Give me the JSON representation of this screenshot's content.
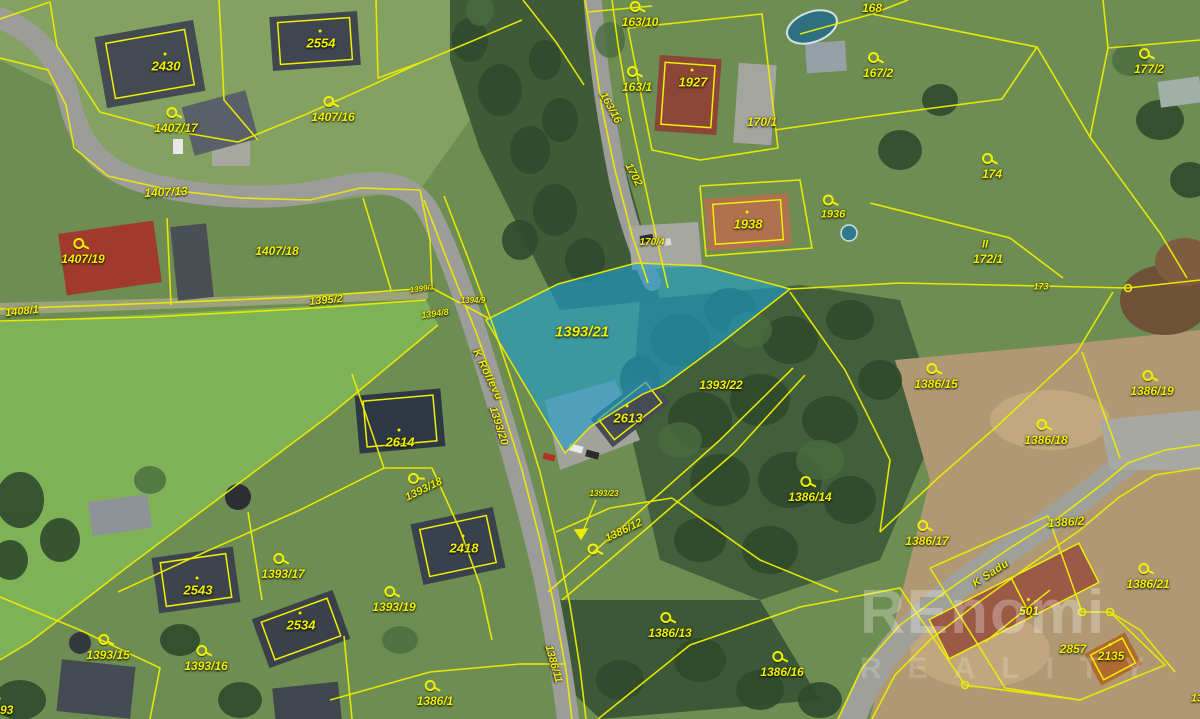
{
  "map": {
    "highlighted_parcel": "1393/21",
    "colors": {
      "boundary": "#f0f000",
      "highlight_fill": "#1d9ecf",
      "watermark": "#ffffff"
    },
    "watermark": {
      "line1": "REnomi",
      "line2": "REALITY"
    },
    "labels": [
      {
        "text": "2430",
        "x": 166,
        "y": 66,
        "size": 13,
        "kind": "building"
      },
      {
        "text": "2554",
        "x": 321,
        "y": 43,
        "size": 13,
        "kind": "building"
      },
      {
        "text": "1407/17",
        "x": 176,
        "y": 128,
        "size": 12,
        "marker": true
      },
      {
        "text": "1407/16",
        "x": 333,
        "y": 117,
        "size": 12,
        "marker": true
      },
      {
        "text": "1407/13",
        "x": 166,
        "y": 192,
        "size": 12,
        "rot": -3
      },
      {
        "text": "1407/19",
        "x": 83,
        "y": 259,
        "size": 12,
        "marker": true
      },
      {
        "text": "1407/18",
        "x": 277,
        "y": 251,
        "size": 12
      },
      {
        "text": "1408/1",
        "x": 22,
        "y": 312,
        "size": 11,
        "rot": -6
      },
      {
        "text": "1395/2",
        "x": 326,
        "y": 301,
        "size": 11,
        "rot": -5
      },
      {
        "text": "163/10",
        "x": 640,
        "y": 22,
        "size": 12,
        "marker": true
      },
      {
        "text": "168",
        "x": 872,
        "y": 8,
        "size": 12
      },
      {
        "text": "163/1",
        "x": 637,
        "y": 87,
        "size": 12,
        "marker": true
      },
      {
        "text": "1927",
        "x": 693,
        "y": 82,
        "size": 13,
        "kind": "building"
      },
      {
        "text": "167/2",
        "x": 878,
        "y": 73,
        "size": 12,
        "marker": true
      },
      {
        "text": "177/2",
        "x": 1149,
        "y": 69,
        "size": 12,
        "marker": true
      },
      {
        "text": "170/1",
        "x": 762,
        "y": 122,
        "size": 12
      },
      {
        "text": "163/16",
        "x": 610,
        "y": 108,
        "size": 11,
        "rot": 62
      },
      {
        "text": "1702",
        "x": 633,
        "y": 175,
        "size": 11,
        "rot": 62
      },
      {
        "text": "170/4",
        "x": 652,
        "y": 243,
        "size": 10
      },
      {
        "text": "1938",
        "x": 748,
        "y": 224,
        "size": 13,
        "kind": "building"
      },
      {
        "text": "1936",
        "x": 833,
        "y": 215,
        "size": 11,
        "marker": true
      },
      {
        "text": "174",
        "x": 992,
        "y": 174,
        "size": 12,
        "marker": true
      },
      {
        "text": "II",
        "x": 985,
        "y": 245,
        "size": 11,
        "kind": "symbol"
      },
      {
        "text": "172/1",
        "x": 988,
        "y": 259,
        "size": 12
      },
      {
        "text": "173",
        "x": 1041,
        "y": 287,
        "size": 9
      },
      {
        "text": "1393/21",
        "x": 582,
        "y": 332,
        "size": 15
      },
      {
        "text": "1399/1",
        "x": 422,
        "y": 289,
        "size": 8,
        "rot": -8
      },
      {
        "text": "1394/9",
        "x": 473,
        "y": 301,
        "size": 8
      },
      {
        "text": "1394/8",
        "x": 435,
        "y": 314,
        "size": 9,
        "rot": -8
      },
      {
        "text": "K Rollevu",
        "x": 487,
        "y": 375,
        "size": 11,
        "rot": 64,
        "kind": "street"
      },
      {
        "text": "1393/20",
        "x": 498,
        "y": 426,
        "size": 11,
        "rot": 72
      },
      {
        "text": "2614",
        "x": 400,
        "y": 442,
        "size": 13,
        "kind": "building"
      },
      {
        "text": "1393/18",
        "x": 424,
        "y": 490,
        "size": 11,
        "rot": -26,
        "marker": true
      },
      {
        "text": "2613",
        "x": 628,
        "y": 418,
        "size": 13,
        "kind": "building"
      },
      {
        "text": "1393/22",
        "x": 721,
        "y": 385,
        "size": 12
      },
      {
        "text": "1393/23",
        "x": 604,
        "y": 494,
        "size": 8
      },
      {
        "text": "1386/12",
        "x": 624,
        "y": 531,
        "size": 11,
        "rot": -26
      },
      {
        "text": "",
        "x": 592,
        "y": 549,
        "marker": true,
        "kind": "marker-only"
      },
      {
        "text": "1386/14",
        "x": 810,
        "y": 497,
        "size": 12,
        "marker": true
      },
      {
        "text": "1386/15",
        "x": 936,
        "y": 384,
        "size": 12,
        "marker": true
      },
      {
        "text": "1386/18",
        "x": 1046,
        "y": 440,
        "size": 12,
        "marker": true
      },
      {
        "text": "1386/19",
        "x": 1152,
        "y": 391,
        "size": 12,
        "marker": true
      },
      {
        "text": "1386/2",
        "x": 1066,
        "y": 522,
        "size": 12,
        "rot": -4
      },
      {
        "text": "1386/17",
        "x": 927,
        "y": 541,
        "size": 12,
        "marker": true
      },
      {
        "text": "K Sadu",
        "x": 991,
        "y": 574,
        "size": 11,
        "rot": -33,
        "kind": "street"
      },
      {
        "text": "1386/21",
        "x": 1148,
        "y": 584,
        "size": 12,
        "marker": true
      },
      {
        "text": "501",
        "x": 1029,
        "y": 611,
        "size": 12,
        "kind": "building"
      },
      {
        "text": "2857",
        "x": 1073,
        "y": 649,
        "size": 12
      },
      {
        "text": "2135",
        "x": 1111,
        "y": 656,
        "size": 12,
        "kind": "building"
      },
      {
        "text": "1386/16",
        "x": 782,
        "y": 672,
        "size": 12,
        "marker": true
      },
      {
        "text": "1386/13",
        "x": 670,
        "y": 633,
        "size": 12,
        "marker": true
      },
      {
        "text": "1386/11",
        "x": 553,
        "y": 664,
        "size": 11,
        "rot": 74
      },
      {
        "text": "1386/1",
        "x": 435,
        "y": 701,
        "size": 12,
        "marker": true
      },
      {
        "text": "1393/19",
        "x": 394,
        "y": 607,
        "size": 12,
        "marker": true
      },
      {
        "text": "2418",
        "x": 464,
        "y": 548,
        "size": 13,
        "kind": "building"
      },
      {
        "text": "2543",
        "x": 198,
        "y": 590,
        "size": 13,
        "kind": "building"
      },
      {
        "text": "1393/17",
        "x": 283,
        "y": 574,
        "size": 12,
        "marker": true
      },
      {
        "text": "2534",
        "x": 301,
        "y": 625,
        "size": 13,
        "kind": "building"
      },
      {
        "text": "1393/15",
        "x": 108,
        "y": 655,
        "size": 12,
        "marker": true
      },
      {
        "text": "1393/16",
        "x": 206,
        "y": 666,
        "size": 12,
        "marker": true
      },
      {
        "text": "2593",
        "x": 0,
        "y": 710,
        "size": 12,
        "kind": "building"
      },
      {
        "text": "13",
        "x": 1197,
        "y": 699,
        "size": 11
      }
    ]
  }
}
